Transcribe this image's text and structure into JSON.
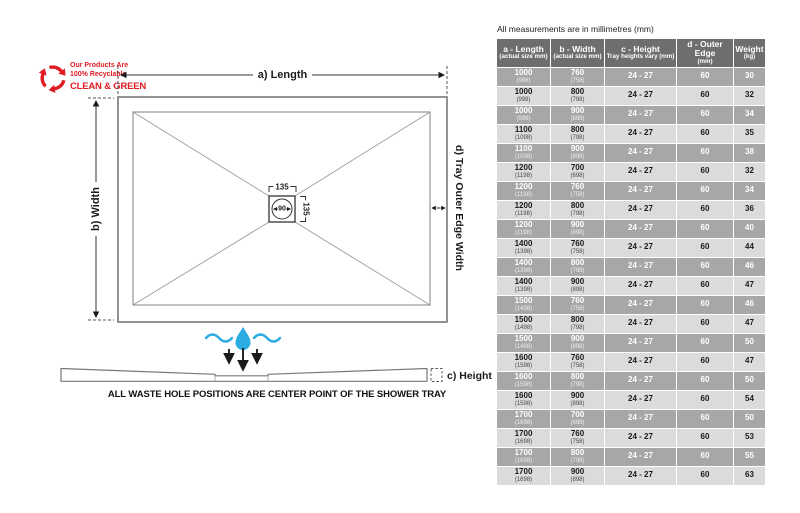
{
  "note": "All measurements are in millimetres (mm)",
  "logo": {
    "line1": "Our Products Are",
    "line2": "100% Recyclable",
    "line3": "CLEAN & GREEN"
  },
  "diagram": {
    "length_label": "a) Length",
    "width_label": "b) Width",
    "outer_edge_label": "d) Tray Outer Edge Width",
    "height_label": "c) Height",
    "waste_width": "135",
    "waste_depth": "135",
    "waste_diameter": "90",
    "caption": "ALL WASTE HOLE POSITIONS ARE CENTER POINT OF THE SHOWER TRAY"
  },
  "colors": {
    "accent_red": "#e01b22",
    "accent_blue": "#2aabe2",
    "line_gray": "#77787b",
    "dim_black": "#1b1b1b",
    "header_bg": "#6d6e70",
    "row_dark": "#a8a6a7",
    "row_light": "#dbdbdb"
  },
  "table": {
    "headers": [
      {
        "title": "a - Length",
        "sub": "(actual size mm)"
      },
      {
        "title": "b - Width",
        "sub": "(actual size mm)"
      },
      {
        "title": "c - Height",
        "sub": "Tray heights vary (mm)"
      },
      {
        "title": "d - Outer Edge",
        "sub": "(mm)"
      },
      {
        "title": "Weight",
        "sub": "(kg)"
      }
    ],
    "rows": [
      {
        "length": "1000",
        "length_sub": "(998)",
        "width": "760",
        "width_sub": "(758)",
        "height": "24 - 27",
        "outer_edge": "60",
        "weight": "30"
      },
      {
        "length": "1000",
        "length_sub": "(998)",
        "width": "800",
        "width_sub": "(798)",
        "height": "24 - 27",
        "outer_edge": "60",
        "weight": "32"
      },
      {
        "length": "1000",
        "length_sub": "(998)",
        "width": "900",
        "width_sub": "(898)",
        "height": "24 - 27",
        "outer_edge": "60",
        "weight": "34"
      },
      {
        "length": "1100",
        "length_sub": "(1098)",
        "width": "800",
        "width_sub": "(798)",
        "height": "24 - 27",
        "outer_edge": "60",
        "weight": "35"
      },
      {
        "length": "1100",
        "length_sub": "(1098)",
        "width": "900",
        "width_sub": "(898)",
        "height": "24 - 27",
        "outer_edge": "60",
        "weight": "38"
      },
      {
        "length": "1200",
        "length_sub": "(1198)",
        "width": "700",
        "width_sub": "(698)",
        "height": "24 - 27",
        "outer_edge": "60",
        "weight": "32"
      },
      {
        "length": "1200",
        "length_sub": "(1198)",
        "width": "760",
        "width_sub": "(758)",
        "height": "24 - 27",
        "outer_edge": "60",
        "weight": "34"
      },
      {
        "length": "1200",
        "length_sub": "(1198)",
        "width": "800",
        "width_sub": "(798)",
        "height": "24 - 27",
        "outer_edge": "60",
        "weight": "36"
      },
      {
        "length": "1200",
        "length_sub": "(1198)",
        "width": "900",
        "width_sub": "(898)",
        "height": "24 - 27",
        "outer_edge": "60",
        "weight": "40"
      },
      {
        "length": "1400",
        "length_sub": "(1398)",
        "width": "760",
        "width_sub": "(758)",
        "height": "24 - 27",
        "outer_edge": "60",
        "weight": "44"
      },
      {
        "length": "1400",
        "length_sub": "(1398)",
        "width": "800",
        "width_sub": "(798)",
        "height": "24 - 27",
        "outer_edge": "60",
        "weight": "46"
      },
      {
        "length": "1400",
        "length_sub": "(1398)",
        "width": "900",
        "width_sub": "(898)",
        "height": "24 - 27",
        "outer_edge": "60",
        "weight": "47"
      },
      {
        "length": "1500",
        "length_sub": "(1498)",
        "width": "760",
        "width_sub": "(758)",
        "height": "24 - 27",
        "outer_edge": "60",
        "weight": "46"
      },
      {
        "length": "1500",
        "length_sub": "(1498)",
        "width": "800",
        "width_sub": "(798)",
        "height": "24 - 27",
        "outer_edge": "60",
        "weight": "47"
      },
      {
        "length": "1500",
        "length_sub": "(1498)",
        "width": "900",
        "width_sub": "(898)",
        "height": "24 - 27",
        "outer_edge": "60",
        "weight": "50"
      },
      {
        "length": "1600",
        "length_sub": "(1598)",
        "width": "760",
        "width_sub": "(758)",
        "height": "24 - 27",
        "outer_edge": "60",
        "weight": "47"
      },
      {
        "length": "1600",
        "length_sub": "(1598)",
        "width": "800",
        "width_sub": "(798)",
        "height": "24 - 27",
        "outer_edge": "60",
        "weight": "50"
      },
      {
        "length": "1600",
        "length_sub": "(1598)",
        "width": "900",
        "width_sub": "(898)",
        "height": "24 - 27",
        "outer_edge": "60",
        "weight": "54"
      },
      {
        "length": "1700",
        "length_sub": "(1698)",
        "width": "700",
        "width_sub": "(698)",
        "height": "24 - 27",
        "outer_edge": "60",
        "weight": "50"
      },
      {
        "length": "1700",
        "length_sub": "(1698)",
        "width": "760",
        "width_sub": "(758)",
        "height": "24 - 27",
        "outer_edge": "60",
        "weight": "53"
      },
      {
        "length": "1700",
        "length_sub": "(1698)",
        "width": "800",
        "width_sub": "(798)",
        "height": "24 - 27",
        "outer_edge": "60",
        "weight": "55"
      },
      {
        "length": "1700",
        "length_sub": "(1698)",
        "width": "900",
        "width_sub": "(898)",
        "height": "24 - 27",
        "outer_edge": "60",
        "weight": "63"
      }
    ]
  }
}
